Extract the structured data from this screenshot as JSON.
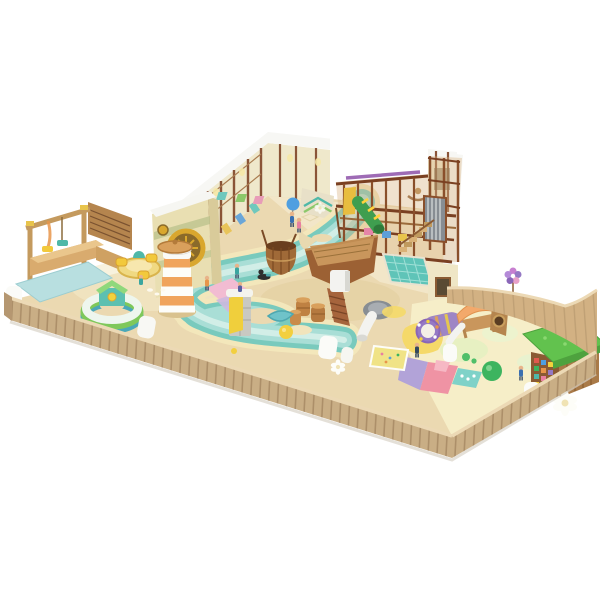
{
  "scene": {
    "type": "3d-render",
    "subject": "indoor children's soft-play playground diorama on white background",
    "background": "#ffffff"
  },
  "palette": {
    "sand": "#ebd9b1",
    "cream": "#f4ead0",
    "toddler_cream": "#f6eec8",
    "river_bank": "#f3e7bb",
    "river_deep": "#79cabd",
    "river_mid": "#a9ded6",
    "river_light": "#d6efe9",
    "fence_wood": "#c9ae85",
    "fence_rim": "#ecd9b5",
    "rim_wood": "#d2b183",
    "wall_cream": "#efe8cb",
    "cap_white": "#f7f7f4",
    "frame_wood": "#8a4f2b",
    "deck_wood": "#c9965c",
    "boat_hull": "#9c6134",
    "slide_gray": "#878d93",
    "slide_white": "#f3f3f0",
    "tube_green": "#3f9e4f",
    "pit_teal": "#5fc4b8",
    "lighthouse_orange": "#f0a45c",
    "gear_gold": "#d9a72e",
    "carousel_yellow": "#f0d982",
    "mat_blue": "#b8dfe0",
    "ring_green": "#7ec85a",
    "ring_teal": "#4aa8b8",
    "patch_purple": "#b2a3d8",
    "patch_pink": "#ef93a4",
    "patch_yellow": "#f5d969",
    "patch_teal": "#7fd2c8",
    "grass_green": "#62c24e",
    "ball_green": "#3db45f",
    "ball_yellow": "#f2cf3f",
    "ball_blue": "#4f9fe0",
    "canopy_orange": "#f3a96b",
    "tunnel_purple": "#9579c4",
    "house_wood": "#a97a48",
    "facade_cream": "#e9dfb2"
  },
  "objects": [
    {
      "id": "back-wall-room",
      "label": "walled play room with white wall caps and doorway opening"
    },
    {
      "id": "climbing-net-wall",
      "label": "wooden climbing frames with nets along back walls"
    },
    {
      "id": "play-frame",
      "label": "two-story wooden climbing structure"
    },
    {
      "id": "green-tube-slide",
      "label": "green tube slide with yellow rings"
    },
    {
      "id": "roller-slide",
      "label": "gray roller slide"
    },
    {
      "id": "staircase",
      "label": "wooden staircase"
    },
    {
      "id": "ball-pit",
      "label": "teal quilted ball pit"
    },
    {
      "id": "pirate-ship",
      "label": "wooden play boat"
    },
    {
      "id": "spiral-slide",
      "label": "gray and white spiral slide"
    },
    {
      "id": "barrels",
      "label": "wooden barrels"
    },
    {
      "id": "wooden-tub",
      "label": "large wooden basket tub"
    },
    {
      "id": "river",
      "label": "winding aqua play river on sand floor"
    },
    {
      "id": "lighthouse",
      "label": "orange striped lighthouse tower with wooden cap"
    },
    {
      "id": "gear-facade",
      "label": "entrance facade with golden gear clock"
    },
    {
      "id": "carousel",
      "label": "yellow toddler carousel spinner"
    },
    {
      "id": "ring-playhouse",
      "label": "striped ring with small playhouse"
    },
    {
      "id": "swing-frame",
      "label": "wooden swing gate frame"
    },
    {
      "id": "blue-mat",
      "label": "light blue toddler mat"
    },
    {
      "id": "caterpillar-tunnel",
      "label": "purple crawl tunnel"
    },
    {
      "id": "canopy-climber",
      "label": "climber with orange canopy and white slide"
    },
    {
      "id": "grass-roof-house",
      "label": "playhouse with green grass roof and mosaic wall"
    },
    {
      "id": "climb-tower",
      "label": "small gray tower with yellow climb panel"
    },
    {
      "id": "wooden-fence",
      "label": "curved wooden plank fence around the floor"
    },
    {
      "id": "kids",
      "label": "small children figures"
    },
    {
      "id": "balls",
      "label": "play balls (blue, yellow, green)"
    }
  ]
}
